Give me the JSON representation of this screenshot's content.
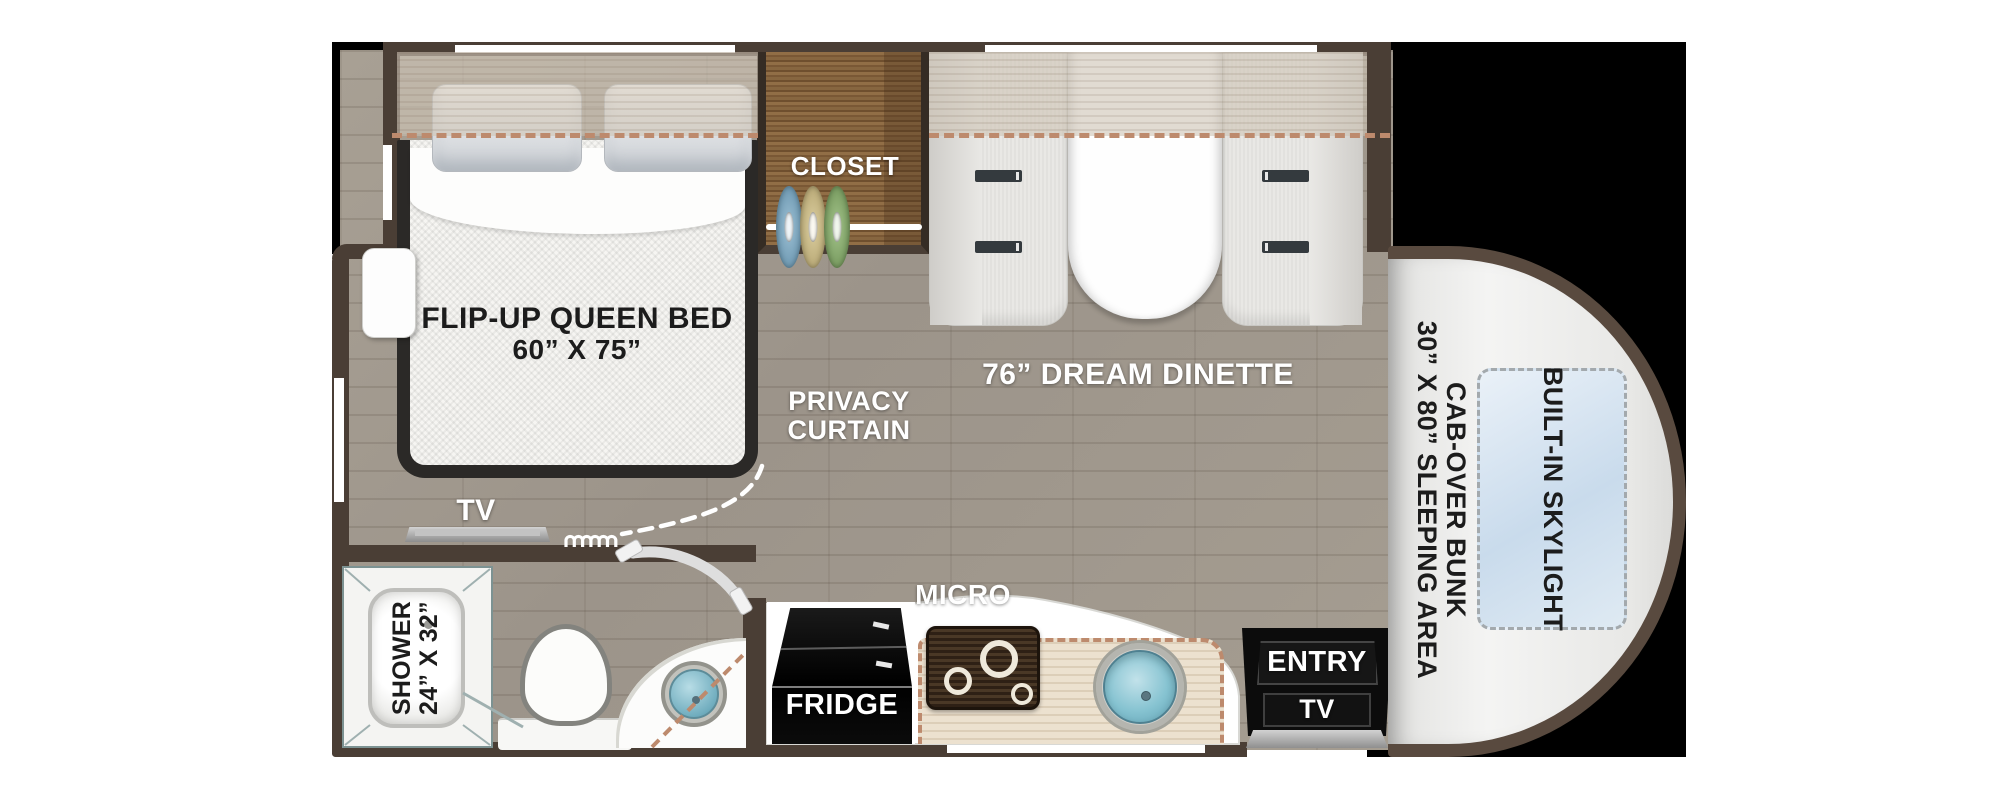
{
  "labels": {
    "closet": "CLOSET",
    "bed": {
      "line1": "FLIP-UP QUEEN BED",
      "line2": "60” X 75”"
    },
    "privacy": {
      "line1": "PRIVACY",
      "line2": "CURTAIN"
    },
    "dinette": "76” DREAM DINETTE",
    "bedroom_tv": "TV",
    "shower": {
      "line1": "SHOWER",
      "line2": "24” X 32”"
    },
    "micro": "MICRO",
    "fridge": "FRIDGE",
    "entry": "ENTRY",
    "entry_tv": "TV",
    "cab_bunk": {
      "line1": "CAB-OVER BUNK",
      "line2": "30” X 80” SLEEPING AREA"
    },
    "skylight": "BUILT-IN SKYLIGHT"
  },
  "colors": {
    "wall": "#4a3e35",
    "backdrop": "#000000",
    "page": "#ffffff",
    "floor": "#a29a8e",
    "closet_wood": "#8a6a44",
    "slide_dash": "#bd8a6d",
    "sink_teal": "#7fbecd",
    "hanger_blue": "#6f9fba",
    "hanger_tan": "#c9b88d",
    "hanger_green": "#7da565",
    "cab_body": "#ededeb",
    "skylight_blue": "#d4e2f0"
  }
}
